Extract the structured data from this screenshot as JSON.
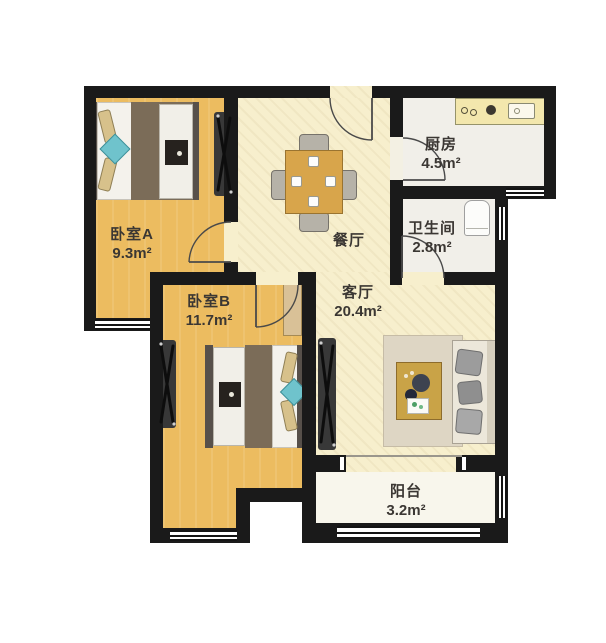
{
  "plan": {
    "type": "apartment-floor-plan",
    "rooms": [
      {
        "name": "卧室A",
        "area": "9.3m²"
      },
      {
        "name": "卧室B",
        "area": "11.7m²"
      },
      {
        "name": "餐厅",
        "area": ""
      },
      {
        "name": "厨房",
        "area": "4.5m²"
      },
      {
        "name": "卫生间",
        "area": "2.8m²"
      },
      {
        "name": "客厅",
        "area": "20.4m²"
      },
      {
        "name": "阳台",
        "area": "3.2m²"
      }
    ],
    "colors": {
      "wall": "#1a1a1a",
      "bedroom_floor": "#ecbc60",
      "hall_floor": "#f7efcd",
      "wet_floor": "#f1efe9",
      "balcony_floor": "#f8f6ec",
      "accent_teal": "#6fc3cc",
      "table_wood": "#d8a54b",
      "label_text": "#3b3733"
    }
  }
}
